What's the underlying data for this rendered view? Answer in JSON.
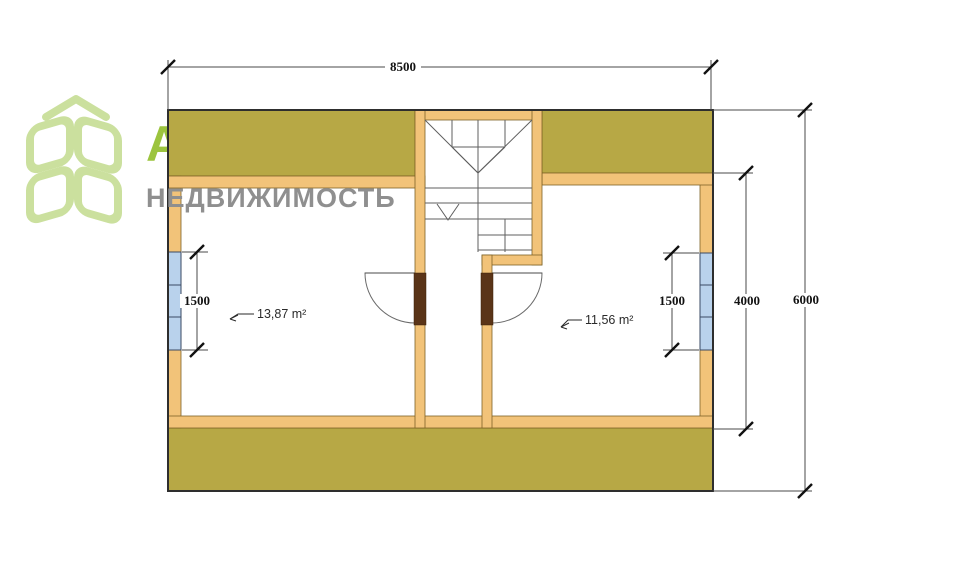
{
  "logo": {
    "title": "АКЦЕНТ",
    "subtitle": "НЕДВИЖИМОСТЬ",
    "icon": "cube-logo-icon"
  },
  "plan": {
    "type": "attic-floor-plan",
    "dimensions": {
      "total_width": "8500",
      "total_height": "6000",
      "right_inner_height": "4000",
      "left_window": "1500",
      "right_window": "1500"
    },
    "rooms": {
      "left_area": "13,87 m²",
      "right_area": "11,56 m²"
    }
  },
  "colors": {
    "roof_olive": "#b3a339",
    "wall_tan": "#f2c379",
    "window_blue": "#b9d2ec",
    "door_brown": "#5a3418",
    "logo_text_green": "#9cc43e",
    "logo_icon_green": "#cbe09e",
    "logo_gray": "#8f8f8f",
    "dim_line": "#4a4a4a"
  }
}
